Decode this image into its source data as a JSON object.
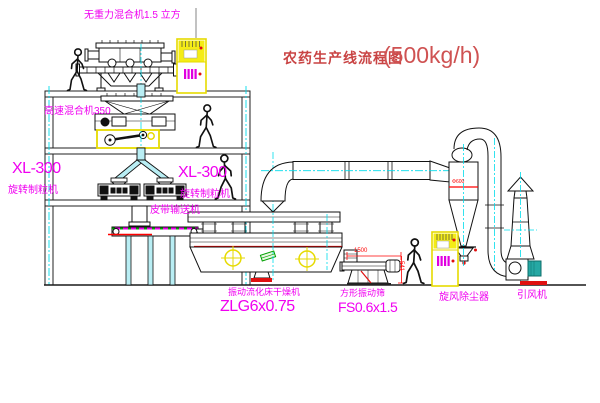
{
  "title": {
    "name_cn": "农药生产线流程图",
    "capacity": "(500kg/h)"
  },
  "labels": {
    "gravity_mixer": "无重力混合机1.5 立方",
    "high_speed_mixer": "高速混合机350",
    "granulator_left_model": "XL-300",
    "granulator_left_name": "旋转制粒机",
    "granulator_center_model": "XL-300",
    "granulator_center_name": "旋转制粒机",
    "belt_conveyor": "皮带输送机",
    "dryer_name": "振动流化床干燥机",
    "dryer_model": "ZLG6x0.75",
    "screen_name": "方形振动筛",
    "screen_model": "FS0.6x1.5",
    "cyclone": "旋风除尘器",
    "fan": "引风机"
  },
  "dimensions": {
    "screen_length": "1500",
    "screen_height": "541",
    "cyclone_diameter": "Φ600"
  },
  "colors": {
    "label_magenta": "#f000f0",
    "title_red": "#c94444",
    "centerline_cyan": "#00dcec",
    "pipe_fill_cyan": "#b9eef4",
    "cad_yellow": "#e6da00",
    "dimension_red": "#ff0000",
    "belt_green": "#00a000",
    "line_black": "#111111"
  }
}
